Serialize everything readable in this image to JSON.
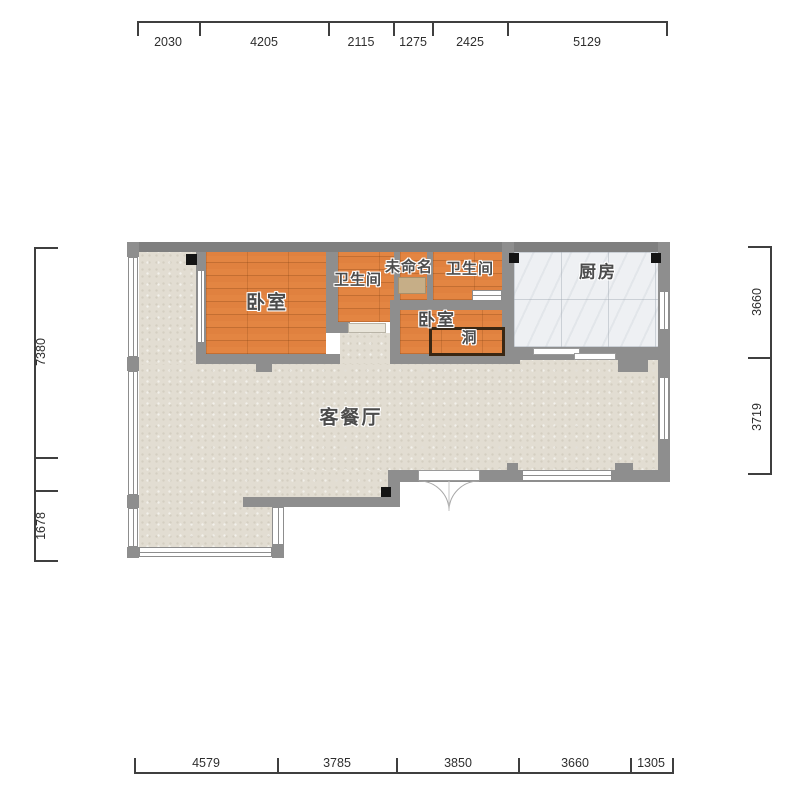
{
  "plan_title": "apartment-floor-plan",
  "rooms": {
    "bedroom1": {
      "label": "卧室"
    },
    "bath1": {
      "label": "卫生间"
    },
    "unnamed": {
      "label": "未命名"
    },
    "bath2": {
      "label": "卫生间"
    },
    "kitchen": {
      "label": "厨房"
    },
    "bedroom2": {
      "label": "卧室"
    },
    "hole": {
      "label": "洞"
    },
    "living": {
      "label": "客餐厅"
    }
  },
  "dimensions": {
    "top": {
      "values": [
        "2030",
        "4205",
        "2115",
        "1275",
        "2425",
        "5129"
      ]
    },
    "bottom": {
      "values": [
        "4579",
        "3785",
        "3850",
        "3660",
        "1305"
      ]
    },
    "left": {
      "values": [
        "7380",
        "1678"
      ]
    },
    "right": {
      "values": [
        "3660",
        "3719"
      ]
    }
  },
  "colors": {
    "wall": "#8e8e8e",
    "wood_floor": "#e0813f",
    "living_floor": "#e2ddd2",
    "kitchen_floor": "#eef0f3",
    "dimension_text": "#2e2e2e",
    "label_text": "#4c4c4c",
    "hole_outline": "#3a2713",
    "pillar": "#141414"
  }
}
